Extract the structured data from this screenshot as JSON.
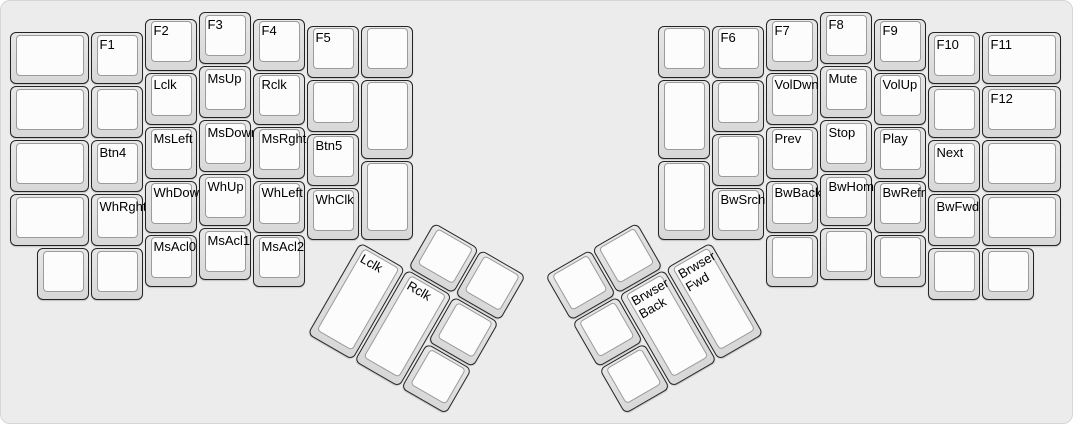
{
  "colors": {
    "page_bg": "#ffffff",
    "canvas_bg": "#ececec",
    "canvas_border": "#d6d6d6",
    "cap_fill_top": "#e7e7e7",
    "cap_fill_bottom": "#d8d8d8",
    "cap_border": "#242424",
    "keytop_fill": "#fcfcfc",
    "keytop_border": "#9b9b9b",
    "label_color": "#000000"
  },
  "layout": {
    "unit": 54,
    "origin_x": 8,
    "origin_y": 10,
    "canvas_width": 1073,
    "canvas_height": 424
  },
  "groups": [
    {
      "name": "left-main-keys",
      "rot": 0,
      "cx": 0,
      "cy": 0,
      "keys": [
        {
          "label": "",
          "x": 0,
          "y": 0.375,
          "w": 1.5
        },
        {
          "label": "",
          "x": 0,
          "y": 1.375,
          "w": 1.5
        },
        {
          "label": "",
          "x": 0,
          "y": 2.375,
          "w": 1.5
        },
        {
          "label": "",
          "x": 0,
          "y": 3.375,
          "w": 1.5
        },
        {
          "label": "F1",
          "x": 1.5,
          "y": 0.375
        },
        {
          "label": "",
          "x": 1.5,
          "y": 1.375
        },
        {
          "label": "Btn4",
          "x": 1.5,
          "y": 2.375
        },
        {
          "label": "WhRght",
          "x": 1.5,
          "y": 3.375
        },
        {
          "label": "F2",
          "x": 2.5,
          "y": 0.125
        },
        {
          "label": "Lclk",
          "x": 2.5,
          "y": 1.125
        },
        {
          "label": "MsLeft",
          "x": 2.5,
          "y": 2.125
        },
        {
          "label": "WhDown",
          "x": 2.5,
          "y": 3.125
        },
        {
          "label": "MsAcl0",
          "x": 2.5,
          "y": 4.125
        },
        {
          "label": "F3",
          "x": 3.5,
          "y": 0
        },
        {
          "label": "MsUp",
          "x": 3.5,
          "y": 1
        },
        {
          "label": "MsDown",
          "x": 3.5,
          "y": 2
        },
        {
          "label": "WhUp",
          "x": 3.5,
          "y": 3
        },
        {
          "label": "MsAcl1",
          "x": 3.5,
          "y": 4
        },
        {
          "label": "F4",
          "x": 4.5,
          "y": 0.125
        },
        {
          "label": "Rclk",
          "x": 4.5,
          "y": 1.125
        },
        {
          "label": "MsRght",
          "x": 4.5,
          "y": 2.125
        },
        {
          "label": "WhLeft",
          "x": 4.5,
          "y": 3.125
        },
        {
          "label": "MsAcl2",
          "x": 4.5,
          "y": 4.125
        },
        {
          "label": "F5",
          "x": 5.5,
          "y": 0.25
        },
        {
          "label": "",
          "x": 5.5,
          "y": 1.25
        },
        {
          "label": "Btn5",
          "x": 5.5,
          "y": 2.25
        },
        {
          "label": "WhClk",
          "x": 5.5,
          "y": 3.25
        },
        {
          "label": "",
          "x": 6.5,
          "y": 0.25
        },
        {
          "label": "",
          "x": 6.5,
          "y": 1.25,
          "h": 1.5
        },
        {
          "label": "",
          "x": 6.5,
          "y": 2.75,
          "h": 1.5
        },
        {
          "label": "",
          "x": 0.5,
          "y": 4.375
        },
        {
          "label": "",
          "x": 1.5,
          "y": 4.375
        }
      ]
    },
    {
      "name": "right-main-keys",
      "rot": 0,
      "cx": 0,
      "cy": 0,
      "keys": [
        {
          "label": "",
          "x": 12,
          "y": 0.25
        },
        {
          "label": "",
          "x": 12,
          "y": 1.25,
          "h": 1.5
        },
        {
          "label": "",
          "x": 12,
          "y": 2.75,
          "h": 1.5
        },
        {
          "label": "F6",
          "x": 13,
          "y": 0.25
        },
        {
          "label": "",
          "x": 13,
          "y": 1.25
        },
        {
          "label": "",
          "x": 13,
          "y": 2.25
        },
        {
          "label": "BwSrch",
          "x": 13,
          "y": 3.25
        },
        {
          "label": "F7",
          "x": 14,
          "y": 0.125
        },
        {
          "label": "VolDwn",
          "x": 14,
          "y": 1.125
        },
        {
          "label": "Prev",
          "x": 14,
          "y": 2.125
        },
        {
          "label": "BwBack",
          "x": 14,
          "y": 3.125
        },
        {
          "label": "",
          "x": 14,
          "y": 4.125
        },
        {
          "label": "F8",
          "x": 15,
          "y": 0
        },
        {
          "label": "Mute",
          "x": 15,
          "y": 1
        },
        {
          "label": "Stop",
          "x": 15,
          "y": 2
        },
        {
          "label": "BwHome",
          "x": 15,
          "y": 3
        },
        {
          "label": "",
          "x": 15,
          "y": 4
        },
        {
          "label": "F9",
          "x": 16,
          "y": 0.125
        },
        {
          "label": "VolUp",
          "x": 16,
          "y": 1.125
        },
        {
          "label": "Play",
          "x": 16,
          "y": 2.125
        },
        {
          "label": "BwRefr",
          "x": 16,
          "y": 3.125
        },
        {
          "label": "",
          "x": 16,
          "y": 4.125
        },
        {
          "label": "F10",
          "x": 17,
          "y": 0.375
        },
        {
          "label": "",
          "x": 17,
          "y": 1.375
        },
        {
          "label": "Next",
          "x": 17,
          "y": 2.375
        },
        {
          "label": "BwFwd",
          "x": 17,
          "y": 3.375
        },
        {
          "label": "F11",
          "x": 18,
          "y": 0.375,
          "w": 1.5
        },
        {
          "label": "F12",
          "x": 18,
          "y": 1.375,
          "w": 1.5
        },
        {
          "label": "",
          "x": 18,
          "y": 2.375,
          "w": 1.5
        },
        {
          "label": "",
          "x": 18,
          "y": 3.375,
          "w": 1.5
        },
        {
          "label": "",
          "x": 17,
          "y": 4.375
        },
        {
          "label": "",
          "x": 18,
          "y": 4.375
        }
      ]
    },
    {
      "name": "left-thumb-cluster",
      "rot": 30,
      "cx": 6.5,
      "cy": 4.25,
      "keys": [
        {
          "label": "",
          "x": 1,
          "y": -1
        },
        {
          "label": "",
          "x": 2,
          "y": -1
        },
        {
          "label": "Lclk",
          "x": 0,
          "y": 0,
          "h": 2
        },
        {
          "label": "Rclk",
          "x": 1,
          "y": 0,
          "h": 2
        },
        {
          "label": "",
          "x": 2,
          "y": 0
        },
        {
          "label": "",
          "x": 2,
          "y": 1
        }
      ]
    },
    {
      "name": "right-thumb-cluster",
      "rot": -30,
      "cx": 13,
      "cy": 4.25,
      "keys": [
        {
          "label": "",
          "x": -3,
          "y": -1
        },
        {
          "label": "",
          "x": -2,
          "y": -1
        },
        {
          "label": "",
          "x": -3,
          "y": 0
        },
        {
          "label": "Brwser\nBack",
          "x": -2,
          "y": 0,
          "h": 2
        },
        {
          "label": "Brwser\nFwd",
          "x": -1,
          "y": 0,
          "h": 2
        },
        {
          "label": "",
          "x": -3,
          "y": 1
        }
      ]
    }
  ]
}
